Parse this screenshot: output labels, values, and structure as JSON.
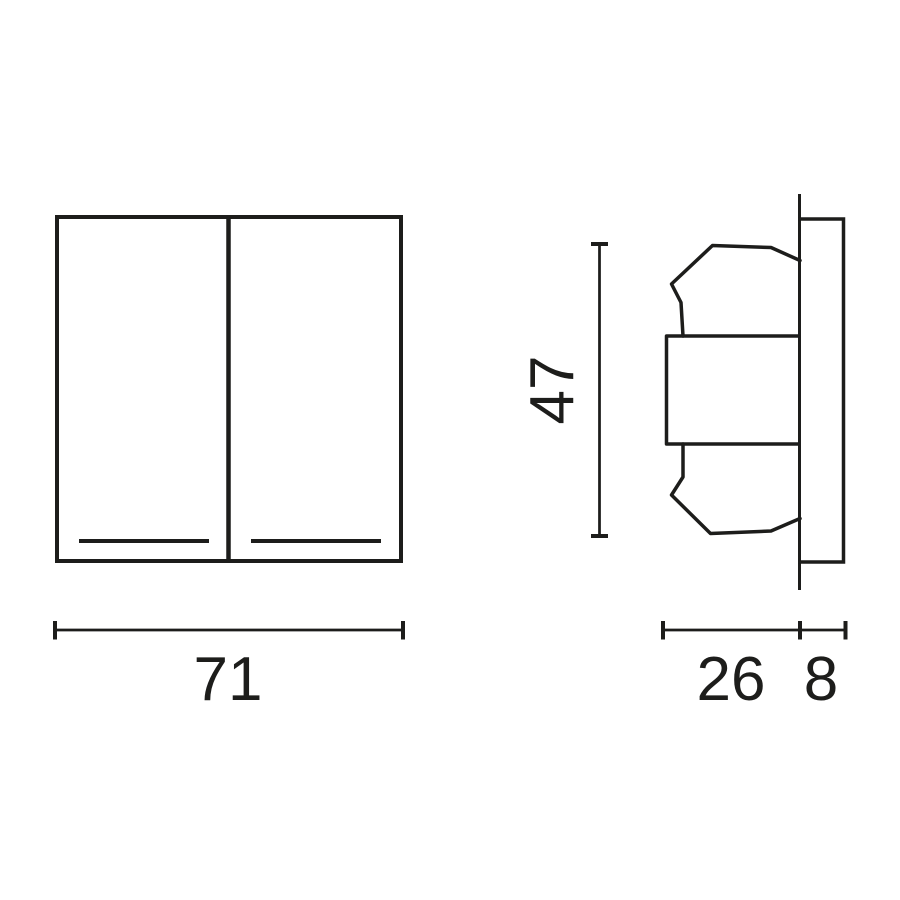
{
  "colors": {
    "line": "#1d1d1b",
    "background": "#ffffff"
  },
  "front_view": {
    "width_value": "71"
  },
  "side_view": {
    "height_value": "47",
    "rocker_depth_value": "26",
    "plate_depth_value": "8"
  }
}
